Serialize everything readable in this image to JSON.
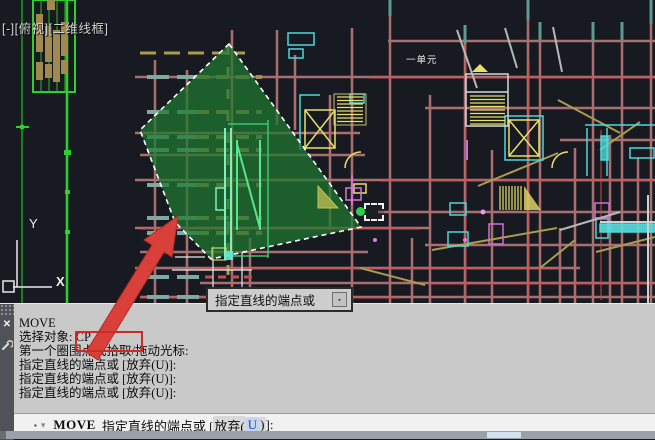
{
  "viewport_controls": {
    "minimize": "[-]",
    "view": "[俯视]",
    "visual_style": "[二维线框]"
  },
  "canvas": {
    "unit_label": "一单元",
    "axis_labels": {
      "x": "X",
      "y": "Y"
    },
    "colors": {
      "background": "#171b21",
      "grid_salmon": "#b97878",
      "grid_red": "#d34545",
      "wall_cyan": "#4fd8d8",
      "detail_yellow": "#e8e06a",
      "selection_fill": "#1f7a30",
      "ucs_white": "#e8e8e8",
      "left_green": "#2ecf2e",
      "annotation_red": "#d94039",
      "snap_green": "#2bcf4e"
    }
  },
  "tooltip": {
    "text": "指定直线的端点或",
    "button_glyph": "▪"
  },
  "command_window": {
    "history": [
      {
        "text": "MOVE"
      },
      {
        "prompt": "选择对象: ",
        "highlight": "CP"
      },
      {
        "text": "第一个圈围点或拾取/拖动光标:"
      },
      {
        "text": "指定直线的端点或 [放弃(U)]:"
      },
      {
        "text": "指定直线的端点或 [放弃(U)]:"
      },
      {
        "text": "指定直线的端点或 [放弃(U)]:"
      }
    ],
    "active": {
      "command": "MOVE",
      "prompt": "指定直线的端点或 [",
      "option_text": "放弃(",
      "option_key": "U",
      "option_close": ")",
      "suffix": "]:"
    },
    "icons": {
      "close": "✕",
      "marker": "▪",
      "recent": "▾"
    }
  }
}
